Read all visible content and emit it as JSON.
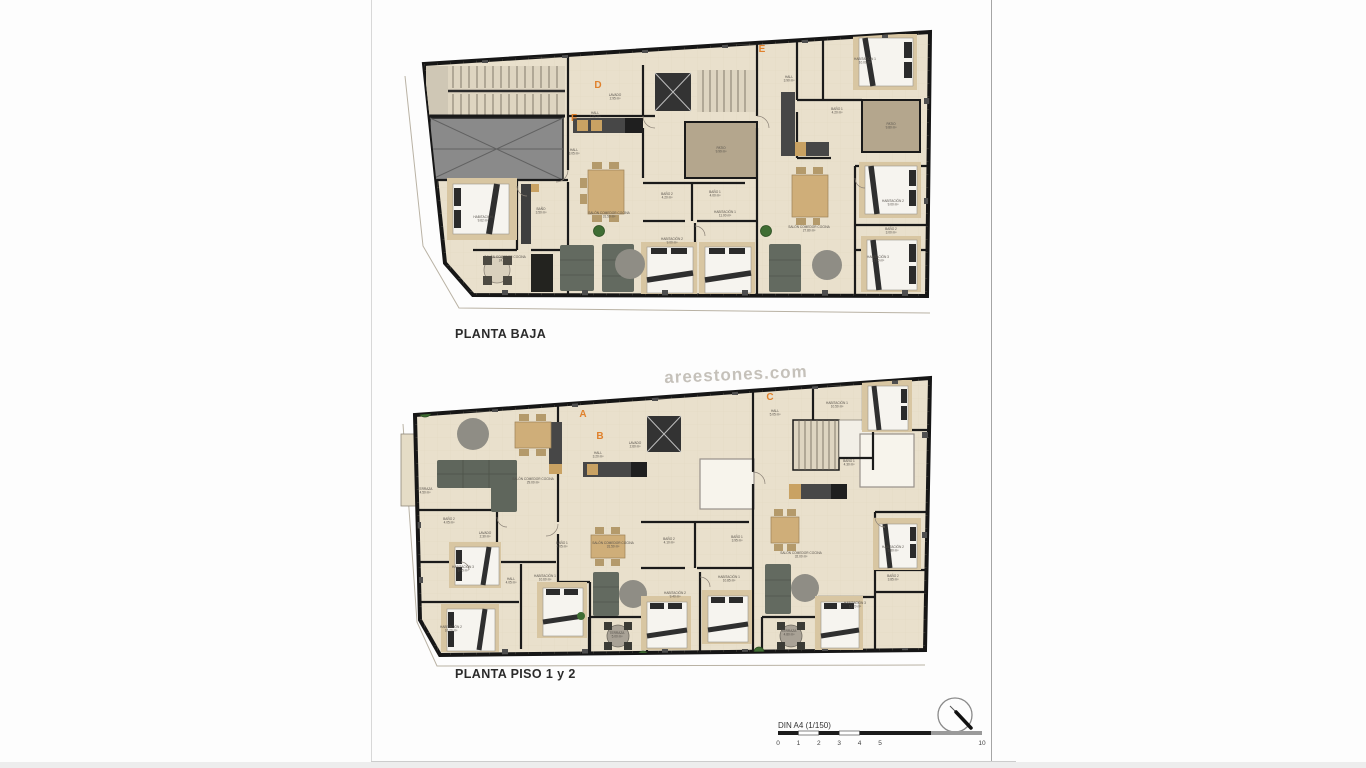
{
  "document": {
    "plan1_title": "PLANTA BAJA",
    "plan2_title": "PLANTA PISO 1 y 2",
    "watermark": "areestones.com",
    "scale": {
      "label": "DIN A4 (1/150)",
      "ticks": [
        0,
        1,
        2,
        3,
        4,
        5,
        10
      ]
    }
  },
  "colors": {
    "floor": "#e9e0cc",
    "wall": "#1a1a1a",
    "patio_brown": "#b4a68d",
    "roof_gray": "#8a8a8a",
    "unit_letter_orange": "#e0812c",
    "sofa": "#636a60",
    "wood": "#cfae79",
    "plant": "#3f6d33"
  },
  "plan1": {
    "units": [
      {
        "letter": "D",
        "x": 213,
        "y": 70
      },
      {
        "letter": "F",
        "x": 189,
        "y": 103
      },
      {
        "letter": "E",
        "x": 377,
        "y": 34
      }
    ],
    "rooms": [
      {
        "name": "HALL",
        "area": "3.05 m²",
        "x": 189,
        "y": 133
      },
      {
        "name": "BAÑO",
        "area": "3.50 m²",
        "x": 156,
        "y": 192
      },
      {
        "name": "HABITACIÓN",
        "area": "9.62 m²",
        "x": 98,
        "y": 200
      },
      {
        "name": "SALÓN COMEDOR COCINA",
        "area": "24.70 m²",
        "x": 120,
        "y": 240
      },
      {
        "name": "LAVADO",
        "area": "2.95 m²",
        "x": 230,
        "y": 78
      },
      {
        "name": "HALL",
        "area": "7.05 m²",
        "x": 210,
        "y": 96
      },
      {
        "name": "SALÓN COMEDOR COCINA",
        "area": "31.50 m²",
        "x": 224,
        "y": 196
      },
      {
        "name": "BAÑO 2",
        "area": "4.20 m²",
        "x": 282,
        "y": 177
      },
      {
        "name": "BAÑO 1",
        "area": "4.00 m²",
        "x": 330,
        "y": 175
      },
      {
        "name": "HABITACIÓN 2",
        "area": "9.00 m²",
        "x": 287,
        "y": 222
      },
      {
        "name": "HABITACIÓN 1",
        "area": "11.00 m²",
        "x": 340,
        "y": 195
      },
      {
        "name": "PATIO",
        "area": "9.99 m²",
        "x": 336,
        "y": 131
      },
      {
        "name": "HALL",
        "area": "3.90 m²",
        "x": 404,
        "y": 60
      },
      {
        "name": "HABITACIÓN 1",
        "area": "10.00 m²",
        "x": 480,
        "y": 42
      },
      {
        "name": "BAÑO 1",
        "area": "4.20 m²",
        "x": 452,
        "y": 92
      },
      {
        "name": "PATIO",
        "area": "9.80 m²",
        "x": 506,
        "y": 107
      },
      {
        "name": "SALÓN COMEDOR COCINA",
        "area": "27.80 m²",
        "x": 424,
        "y": 210
      },
      {
        "name": "HABITACIÓN 2",
        "area": "9.00 m²",
        "x": 508,
        "y": 184
      },
      {
        "name": "BAÑO 2",
        "area": "3.00 m²",
        "x": 506,
        "y": 212
      },
      {
        "name": "HABITACIÓN 3",
        "area": "11.00 m²",
        "x": 493,
        "y": 240
      }
    ]
  },
  "plan2": {
    "units": [
      {
        "letter": "A",
        "x": 198,
        "y": 45
      },
      {
        "letter": "B",
        "x": 215,
        "y": 67
      },
      {
        "letter": "C",
        "x": 385,
        "y": 28
      }
    ],
    "rooms": [
      {
        "name": "TERRAZA",
        "area": "4.50 m²",
        "x": 40,
        "y": 118
      },
      {
        "name": "SALÓN COMEDOR COCINA",
        "area": "29.00 m²",
        "x": 148,
        "y": 108
      },
      {
        "name": "BAÑO 2",
        "area": "4.05 m²",
        "x": 64,
        "y": 148
      },
      {
        "name": "LAVADO",
        "area": "2.30 m²",
        "x": 100,
        "y": 162
      },
      {
        "name": "BAÑO 1",
        "area": "4.05 m²",
        "x": 177,
        "y": 172
      },
      {
        "name": "HABITACIÓN 3",
        "area": "9.45 m²",
        "x": 78,
        "y": 196
      },
      {
        "name": "HALL",
        "area": "4.05 m²",
        "x": 126,
        "y": 208
      },
      {
        "name": "HABITACIÓN 1",
        "area": "10.60 m²",
        "x": 160,
        "y": 205
      },
      {
        "name": "HABITACIÓN 2",
        "area": "10.20 m²",
        "x": 66,
        "y": 256
      },
      {
        "name": "HALL",
        "area": "3.20 m²",
        "x": 213,
        "y": 82
      },
      {
        "name": "LAVADO",
        "area": "2.60 m²",
        "x": 250,
        "y": 72
      },
      {
        "name": "SALÓN COMEDOR COCINA",
        "area": "31.50 m²",
        "x": 228,
        "y": 172
      },
      {
        "name": "BAÑO 2",
        "area": "4.10 m²",
        "x": 284,
        "y": 168
      },
      {
        "name": "BAÑO 1",
        "area": "3.95 m²",
        "x": 352,
        "y": 166
      },
      {
        "name": "HABITACIÓN 1",
        "area": "10.85 m²",
        "x": 344,
        "y": 206
      },
      {
        "name": "HABITACIÓN 2",
        "area": "9.40 m²",
        "x": 290,
        "y": 222
      },
      {
        "name": "TERRAZA",
        "area": "5.00 m²",
        "x": 232,
        "y": 262
      },
      {
        "name": "HALL",
        "area": "5.05 m²",
        "x": 390,
        "y": 40
      },
      {
        "name": "HABITACIÓN 1",
        "area": "10.50 m²",
        "x": 452,
        "y": 32
      },
      {
        "name": "BAÑO 1",
        "area": "4.30 m²",
        "x": 464,
        "y": 90
      },
      {
        "name": "SALÓN COMEDOR COCINA",
        "area": "32.00 m²",
        "x": 416,
        "y": 182
      },
      {
        "name": "HABITACIÓN 2",
        "area": "9.80 m²",
        "x": 508,
        "y": 176
      },
      {
        "name": "BAÑO 2",
        "area": "3.85 m²",
        "x": 508,
        "y": 205
      },
      {
        "name": "HABITACIÓN 3",
        "area": "11.20 m²",
        "x": 470,
        "y": 232
      },
      {
        "name": "TERRAZA",
        "area": "4.80 m²",
        "x": 404,
        "y": 260
      }
    ]
  }
}
